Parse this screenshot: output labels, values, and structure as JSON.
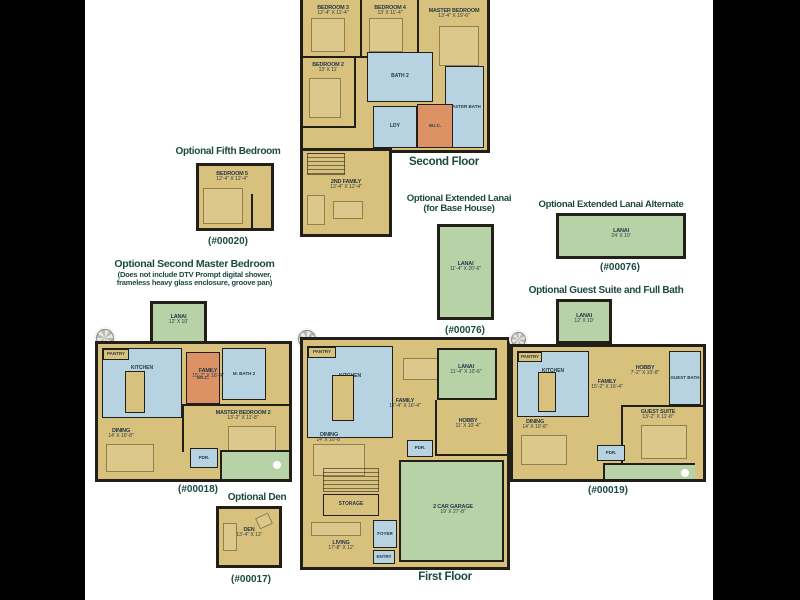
{
  "palette": {
    "floor": "#d8c17c",
    "wet": "#b7d3e2",
    "green": "#b7d2a6",
    "wic": "#dd9266",
    "wall": "#221e18",
    "heading": "#1c4a40",
    "label": "#273a46"
  },
  "figures": {
    "second_floor": {
      "caption": "Second Floor",
      "rooms": {
        "bedroom3": {
          "name": "BEDROOM 3",
          "dim": "12'-4\" X 11'-4\""
        },
        "bedroom4": {
          "name": "BEDROOM 4",
          "dim": "13' X 11'-4\""
        },
        "master_bedroom": {
          "name": "MASTER BEDROOM",
          "dim": "13'-4\" X 19'-6\""
        },
        "bath2": {
          "name": "BATH 2"
        },
        "bedroom2": {
          "name": "BEDROOM 2",
          "dim": "13' X 11'"
        },
        "master_bath": {
          "name": "MASTER BATH"
        },
        "laundry": {
          "name": "LDY"
        },
        "wic": {
          "name": "W.I.C."
        },
        "second_family": {
          "name": "2ND FAMILY",
          "dim": "13'-4\" X 12'-4\""
        }
      }
    },
    "fifth_bedroom": {
      "title": "Optional Fifth Bedroom",
      "plan_no": "(#00020)",
      "rooms": {
        "bedroom5": {
          "name": "BEDROOM 5",
          "dim": "12'-4\" X 12'-4\""
        }
      }
    },
    "extended_lanai": {
      "title": "Optional Extended Lanai",
      "title2": "(for Base House)",
      "plan_no": "(#00076)",
      "rooms": {
        "lanai": {
          "name": "LANAI",
          "dim": "11'-4\" X 20'-6\""
        }
      }
    },
    "extended_lanai_alt": {
      "title": "Optional Extended Lanai Alternate",
      "plan_no": "(#00076)",
      "rooms": {
        "lanai": {
          "name": "LANAI",
          "dim": "24' X 10'"
        }
      }
    },
    "second_master": {
      "title": "Optional Second Master Bedroom",
      "subtitle1": "(Does not include DTV Prompt digital shower,",
      "subtitle2": "frameless heavy glass enclosure, groove pan)",
      "plan_no": "(#00018)",
      "rooms": {
        "lanai": {
          "name": "LANAI",
          "dim": "12' X 10'"
        },
        "pantry": {
          "name": "PANTRY"
        },
        "kitchen": {
          "name": "KITCHEN"
        },
        "family": {
          "name": "FAMILY",
          "dim": "15'-2\" X 16'-4\""
        },
        "wic": {
          "name": "W.I.C."
        },
        "master_bath2": {
          "name": "M. BATH 2"
        },
        "master_bedroom2": {
          "name": "MASTER BEDROOM 2",
          "dim": "13'-2\" X 11'-8\""
        },
        "dining": {
          "name": "DINING",
          "dim": "14' X 10'-8\""
        },
        "powder": {
          "name": "PDR."
        }
      }
    },
    "first_floor": {
      "caption": "First Floor",
      "rooms": {
        "pantry": {
          "name": "PANTRY"
        },
        "kitchen": {
          "name": "KITCHEN"
        },
        "family": {
          "name": "FAMILY",
          "dim": "17'-4\" X 16'-4\""
        },
        "lanai": {
          "name": "LANAI",
          "dim": "11'-4\" X 10'-6\""
        },
        "hobby": {
          "name": "HOBBY",
          "dim": "11' X 10'-4\""
        },
        "dining": {
          "name": "DINING",
          "dim": "14' X 10'-8\""
        },
        "powder": {
          "name": "PDR."
        },
        "storage": {
          "name": "STORAGE"
        },
        "foyer": {
          "name": "FOYER"
        },
        "entry": {
          "name": "ENTRY"
        },
        "living": {
          "name": "LIVING",
          "dim": "17'-8\" X 12'"
        },
        "garage": {
          "name": "2 CAR GARAGE",
          "dim": "19' X 27'-8\""
        }
      }
    },
    "guest_suite": {
      "title": "Optional Guest Suite and Full Bath",
      "plan_no": "(#00019)",
      "rooms": {
        "lanai": {
          "name": "LANAI",
          "dim": "12' X 10'"
        },
        "pantry": {
          "name": "PANTRY"
        },
        "kitchen": {
          "name": "KITCHEN"
        },
        "family": {
          "name": "FAMILY",
          "dim": "15'-2\" X 16'-4\""
        },
        "hobby": {
          "name": "HOBBY",
          "dim": "7'-2\" X 10'-8\""
        },
        "guest_bath": {
          "name": "GUEST BATH"
        },
        "dining": {
          "name": "DINING",
          "dim": "14' X 10'-8\""
        },
        "guest_suite": {
          "name": "GUEST SUITE",
          "dim": "13'-2\" X 11'-8\""
        },
        "powder": {
          "name": "PDR."
        }
      }
    },
    "den": {
      "title": "Optional Den",
      "plan_no": "(#00017)",
      "rooms": {
        "den": {
          "name": "DEN",
          "dim": "13'-4\" X 12'"
        }
      }
    }
  }
}
